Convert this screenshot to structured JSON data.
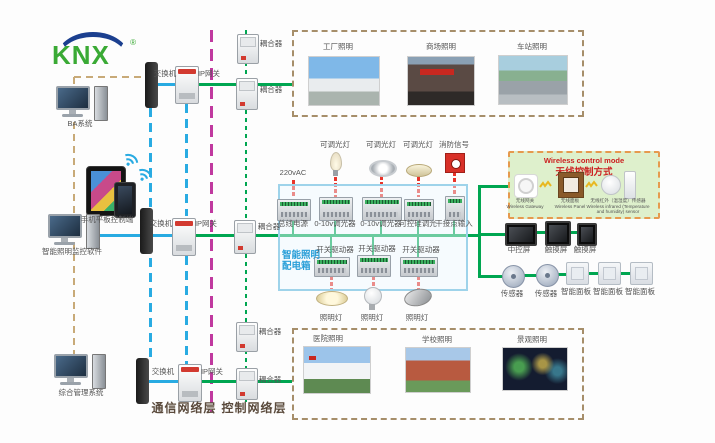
{
  "logo": {
    "text": "KNX",
    "reg": "®"
  },
  "left_column": {
    "ba_system": "BA系统",
    "mobile": "手机平板控制端",
    "monitor_pc": "智能照明监控软件",
    "management": "综合管理系统"
  },
  "network": {
    "switch": "交换机",
    "ip_gateway": "IP网关",
    "coupler": "耦合器"
  },
  "layers": {
    "communication": "通信网络层",
    "control": "控制网络层"
  },
  "top_photos": {
    "items": [
      {
        "label": "工厂照明"
      },
      {
        "label": "商场照明"
      },
      {
        "label": "车站照明"
      }
    ]
  },
  "bottom_photos": {
    "items": [
      {
        "label": "医院照明"
      },
      {
        "label": "学校照明"
      },
      {
        "label": "景观照明"
      }
    ]
  },
  "distribution_box": {
    "title_line1": "智能照明",
    "title_line2": "配电箱",
    "power": "220vAC",
    "dimmable_lamp": "可调光灯",
    "fire_signal": "消防信号",
    "bus_power": "总线电源",
    "dimmer_0_10v": "0-10v调光器",
    "scr_dimmer": "可控硅调光",
    "dry_contact": "干接点输入",
    "switch_actuator": "开关驱动器",
    "lamp": "照明灯"
  },
  "wireless_box": {
    "title_en": "Wireless control mode",
    "title_zh": "无线控制方式",
    "devices": [
      {
        "zh": "无线网关",
        "en": "Wireless Gateway"
      },
      {
        "zh": "无线面板",
        "en": "Wireless Panel"
      },
      {
        "zh": "无线红外（温湿度）传感器",
        "en": "Wireless infrared (Temperature and humidity) sensor"
      }
    ]
  },
  "right_devices": {
    "central_screen": "中控屏",
    "touch_screen": "触摸屏",
    "sensor": "传感器",
    "smart_panel": "智能面板"
  },
  "colors": {
    "knx_green": "#3aaa35",
    "knx_blue": "#1b3f8f",
    "bus_green": "#00a651",
    "ethernet_blue": "#29abe2",
    "backbone_magenta": "#c0399f",
    "power_red": "#e8342a",
    "serial_tan": "#c8aa78",
    "box_border_blue": "#9ed3ea",
    "wireless_bg": "#def0cc",
    "wireless_border": "#e69a4e",
    "photo_frame_tan": "#a68e6a"
  }
}
